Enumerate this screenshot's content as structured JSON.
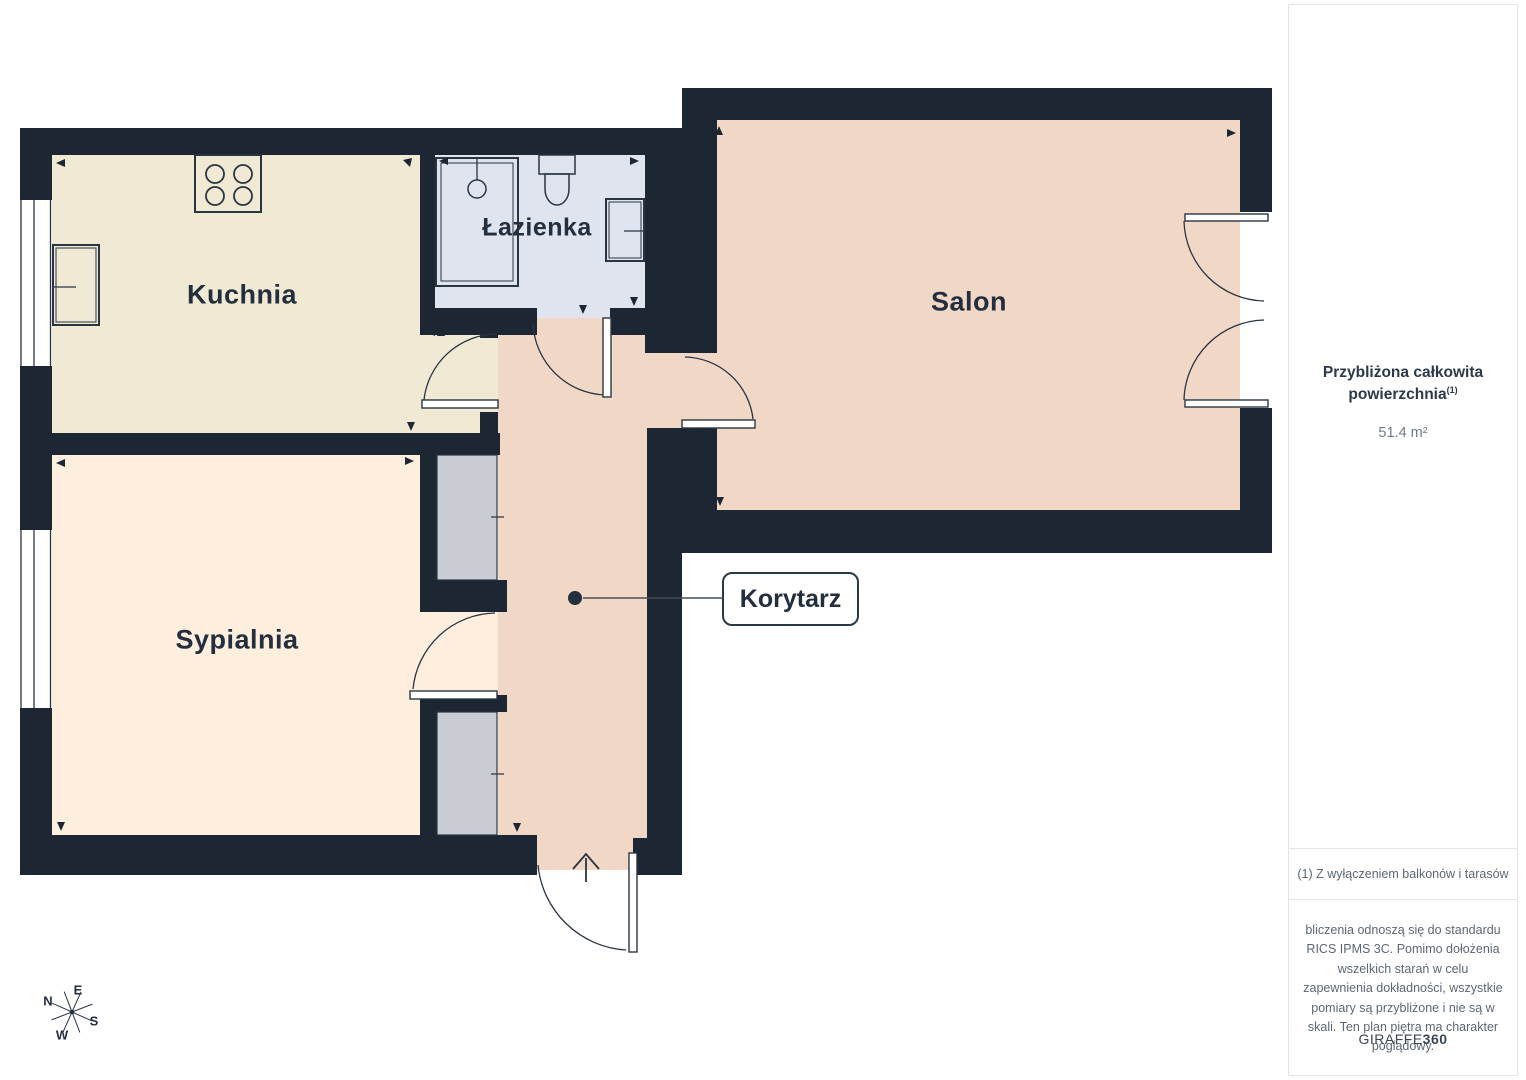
{
  "plan": {
    "rooms": {
      "kitchen": {
        "label": "Kuchnia"
      },
      "bathroom": {
        "label": "Łazienka"
      },
      "salon": {
        "label": "Salon"
      },
      "bedroom": {
        "label": "Sypialnia"
      },
      "corridor": {
        "label": "Korytarz"
      }
    },
    "compass": {
      "n": "N",
      "e": "E",
      "s": "S",
      "w": "W"
    },
    "icons": [
      "stove-icon",
      "kitchen-sink-icon",
      "shower-icon",
      "toilet-icon",
      "bathroom-sink-icon",
      "entrance-arrow-icon",
      "compass-icon"
    ],
    "colors": {
      "wall": "#1d2633",
      "kitchen_floor": "#f0e9d3",
      "bedroom_floor": "#fdeedd",
      "salon_corridor_floor": "#f1d7c6",
      "bathroom_floor": "#dfe4ef",
      "closet_gray": "#c9cdd3",
      "line": "#2a3542"
    }
  },
  "sidebar": {
    "title_line1": "Przybliżona całkowita",
    "title_line2": "powierzchnia",
    "title_sup": "(1)",
    "area_value": "51.4 m²",
    "footnote": "(1) Z wyłączeniem balkonów i tarasów",
    "disclaimer": "bliczenia odnoszą się do standardu RICS IPMS 3C. Pomimo dołożenia wszelkich starań w celu zapewnienia dokładności, wszystkie pomiary są przybliżone i nie są w skali. Ten plan piętra ma charakter poglądowy.",
    "brand_regular": "GIRAFFE",
    "brand_bold": "360"
  }
}
